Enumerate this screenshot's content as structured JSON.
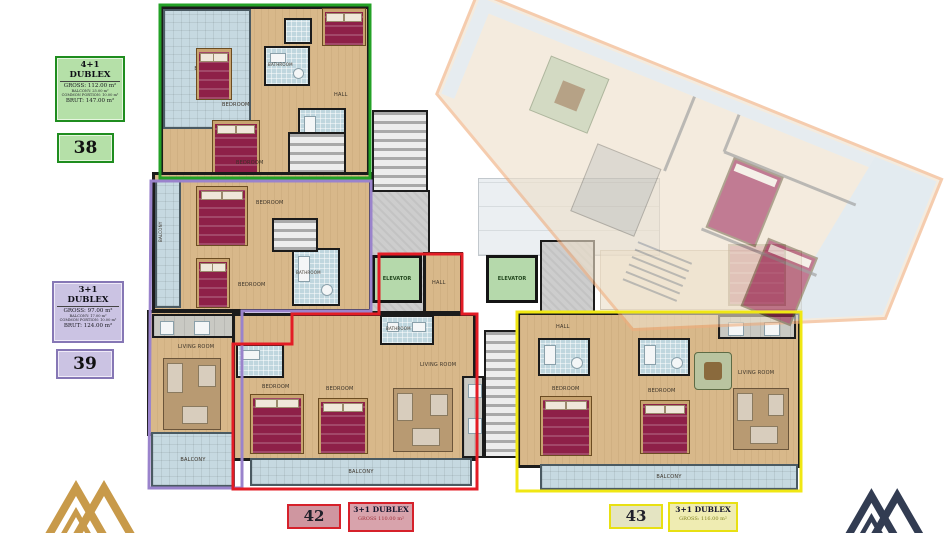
{
  "units": {
    "unit38": {
      "number": "38",
      "type": "4+1 DUBLEX",
      "gross": "GROSS: 112.00 m²",
      "balcony": "BALCONY: 25.00 m²",
      "common": "COMMON PORTION: 10.00 m²",
      "brut": "BRUT: 147.00 m²"
    },
    "unit39": {
      "number": "39",
      "type": "3+1 DUBLEX",
      "gross": "GROSS: 97.00 m²",
      "balcony": "BALCONY: 17.00 m²",
      "common": "COMMON PORTION: 10.00 m²",
      "brut": "BRUT: 124.00 m²"
    },
    "unit42": {
      "number": "42",
      "type": "3+1 DUBLEX",
      "gross": "GROSS 110.00 m²"
    },
    "unit43": {
      "number": "43",
      "type": "3+1 DUBLEX",
      "gross": "GROSS: 116.00 m²"
    }
  },
  "rooms": {
    "elevator": "ELEVATOR",
    "bedroom": "BEDROOM",
    "bathroom": "BATHROOM",
    "living": "LIVING ROOM",
    "balcony": "BALCONY",
    "hall": "HALL"
  },
  "colors": {
    "unit38_outline": "#23a126",
    "unit39_outline": "#9a83cc",
    "unit42_outline": "#e31c25",
    "unit43_outline": "#f0e713",
    "faded_block_outline": "#efae7e",
    "floor": "#d8b88a",
    "bed": "#8e2048",
    "elevator": "#b5d9ab",
    "balcony": "#c6d9e1",
    "logo_gold": "#c89a4a",
    "logo_navy": "#323c52"
  }
}
